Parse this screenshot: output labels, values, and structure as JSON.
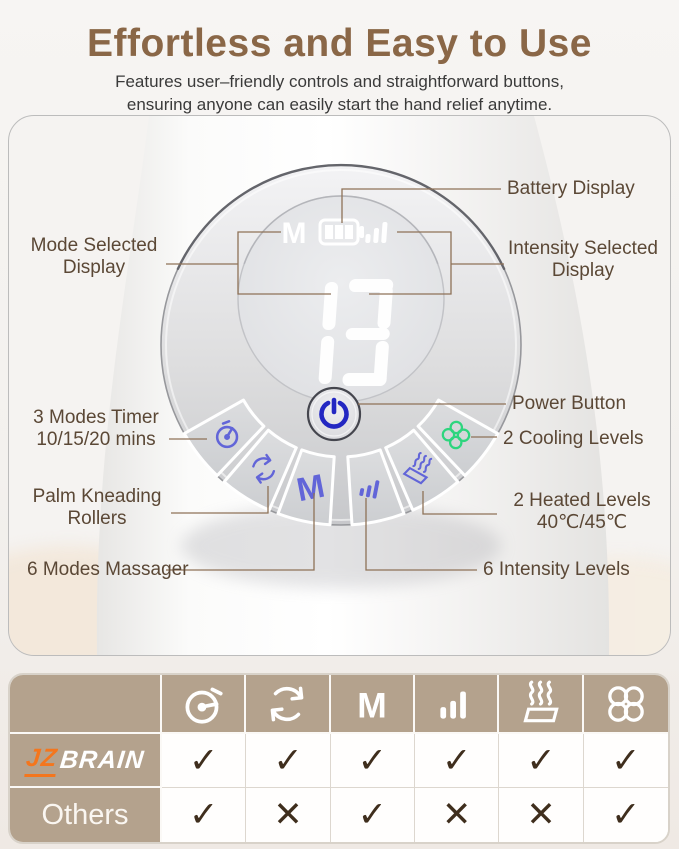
{
  "header": {
    "title": "Effortless and Easy to Use",
    "subtitle_line1": "Features user–friendly controls and straightforward buttons,",
    "subtitle_line2": "ensuring anyone can easily start the hand relief anytime."
  },
  "device": {
    "display": {
      "mode_indicator": "M",
      "battery_icon": "battery-level-3",
      "intensity_icon": "intensity-3-bars",
      "value": "13"
    },
    "buttons": {
      "m_label": "M",
      "icons": [
        "timer-icon",
        "rotation-icon",
        "m-mode-icon",
        "intensity-icon",
        "heat-icon",
        "cooling-fan-icon",
        "power-icon"
      ]
    }
  },
  "callouts": {
    "battery": "Battery Display",
    "mode_line1": "Mode Selected",
    "mode_line2": "Display",
    "intensity_line1": "Intensity Selected",
    "intensity_line2": "Display",
    "timer_line1": "3 Modes Timer",
    "timer_line2": "10/15/20 mins",
    "palm_line1": "Palm Kneading",
    "palm_line2": "Rollers",
    "modes": "6 Modes Massager",
    "power": "Power Button",
    "cooling": "2 Cooling Levels",
    "heated_line1": "2 Heated Levels",
    "heated_line2": "40℃/45℃",
    "intensity_levels": "6 Intensity Levels"
  },
  "comparison": {
    "brand_jz": "JZ",
    "brand_brain": "BRAIN",
    "others_label": "Others",
    "m_label": "M",
    "columns": [
      "timer-icon",
      "rotation-icon",
      "m-mode-icon",
      "intensity-icon",
      "heat-icon",
      "cooling-fan-icon"
    ],
    "rows": [
      {
        "label": "JZBRAIN",
        "values": [
          "✓",
          "✓",
          "✓",
          "✓",
          "✓",
          "✓"
        ]
      },
      {
        "label": "Others",
        "values": [
          "✓",
          "✕",
          "✓",
          "✕",
          "✕",
          "✓"
        ]
      }
    ]
  },
  "colors": {
    "accent_brown": "#8a6747",
    "tan": "#b4a28d",
    "label_text": "#5b4836",
    "leader_line": "#8e7257",
    "button_blue": "#6265d8",
    "power_blue": "#2327c2",
    "cooling_green": "#2ed57e",
    "check_brown": "#3f2e1d",
    "logo_orange": "#f4761d"
  }
}
